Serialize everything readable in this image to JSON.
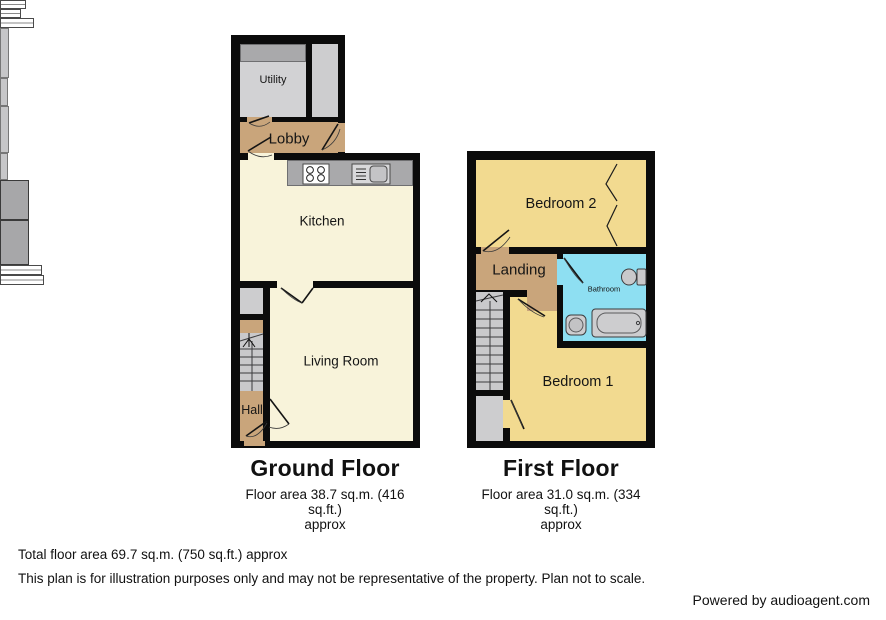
{
  "ground_floor": {
    "title": "Ground Floor",
    "area_line": "Floor area 38.7 sq.m. (416 sq.ft.)",
    "approx": "approx",
    "rooms": {
      "utility": "Utility",
      "lobby": "Lobby",
      "kitchen": "Kitchen",
      "living_room": "Living Room",
      "hall": "Hall"
    }
  },
  "first_floor": {
    "title": "First Floor",
    "area_line": "Floor area 31.0 sq.m. (334 sq.ft.)",
    "approx": "approx",
    "rooms": {
      "bedroom2": "Bedroom 2",
      "landing": "Landing",
      "bathroom": "Bathroom",
      "bedroom1": "Bedroom 1"
    }
  },
  "footer": {
    "total_line": "Total floor area 69.7 sq.m. (750 sq.ft.) approx",
    "disclaimer": "This plan is for illustration purposes only and may not be representative of the property. Plan not to scale.",
    "credit": "Powered by audioagent.com"
  },
  "colors": {
    "wall": "#0b0b0b",
    "kitchen_living_floor": "#f8f3da",
    "hall_lobby_landing_floor": "#c9a57b",
    "bedroom_floor": "#f2da90",
    "bathroom_floor": "#8edff2",
    "utility_floor": "#d2d2d4",
    "counter_gray": "#a9a9ab",
    "stairs_gray": "#c9c9cb"
  },
  "icons": {
    "hob": "four-ring cooktop circles",
    "sink": "sink with drainer",
    "toilet": "toilet cistern and bowl",
    "bath": "bathtub",
    "basin": "round basin",
    "stairs": "staircase with up arrow",
    "wardrobe": "built-in wardrobe with bifold doors",
    "window": "double-line window",
    "door": "door leaf with swing arc"
  }
}
